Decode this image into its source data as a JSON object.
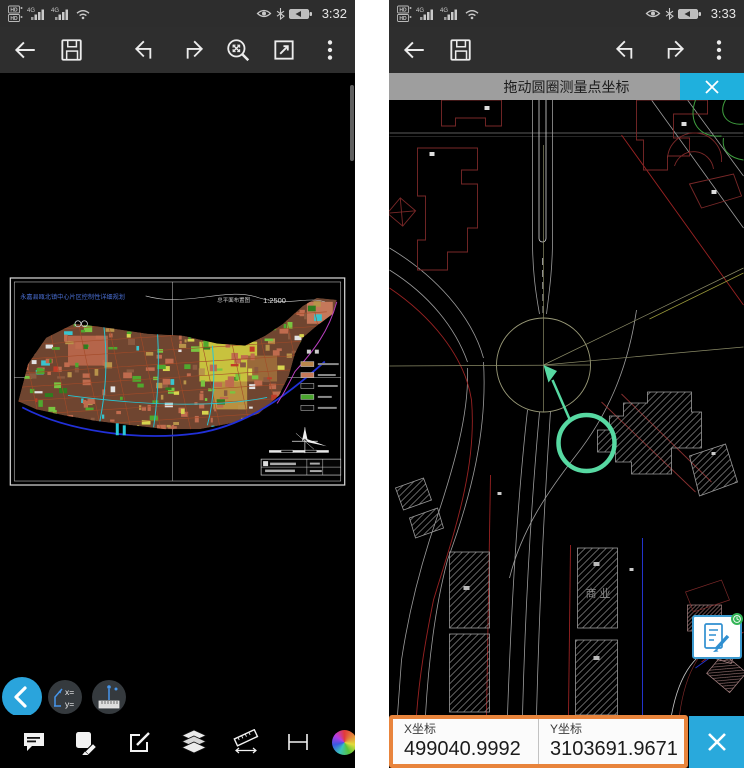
{
  "colors": {
    "accent_cyan": "#29a9dc",
    "banner_gray": "#9e9e9e",
    "panel_orange": "#e8843c",
    "measure_green": "#57d9a2"
  },
  "icons": {
    "back": "left-arrow",
    "save": "floppy-disk",
    "undo": "bent-arrow-left",
    "redo": "bent-arrow-right",
    "zoom_extents": "magnifier-with-arrows",
    "fullscreen": "square-diagonal-arrow",
    "menu": "vertical-dots",
    "close": "x-cross",
    "comment": "speech-bubble",
    "markup": "note-with-pencil",
    "edit": "square-with-pencil",
    "layers": "stacked-sheets",
    "measure": "angled-ruler",
    "dimension": "dimension-lines",
    "palette": "color-wheel"
  },
  "left_phone": {
    "status": {
      "time": "3:32",
      "network_badge": "HD",
      "signal_type": "4G"
    },
    "drawing": {
      "title": "永嘉县瓯北镇中心片区控制性详细规划",
      "view_label": "总平面布置图",
      "scale_label": "1:2500"
    },
    "floating": {
      "x_label": "x=",
      "y_label": "y="
    }
  },
  "right_phone": {
    "status": {
      "time": "3:33",
      "network_badge": "HD",
      "signal_type": "4G"
    },
    "banner": {
      "message": "拖动圆圈测量点坐标"
    },
    "drawing": {
      "area_label": "商业"
    },
    "coord_panel": {
      "x_label": "X坐标",
      "x_value": "499040.9992",
      "y_label": "Y坐标",
      "y_value": "3103691.9671"
    }
  }
}
